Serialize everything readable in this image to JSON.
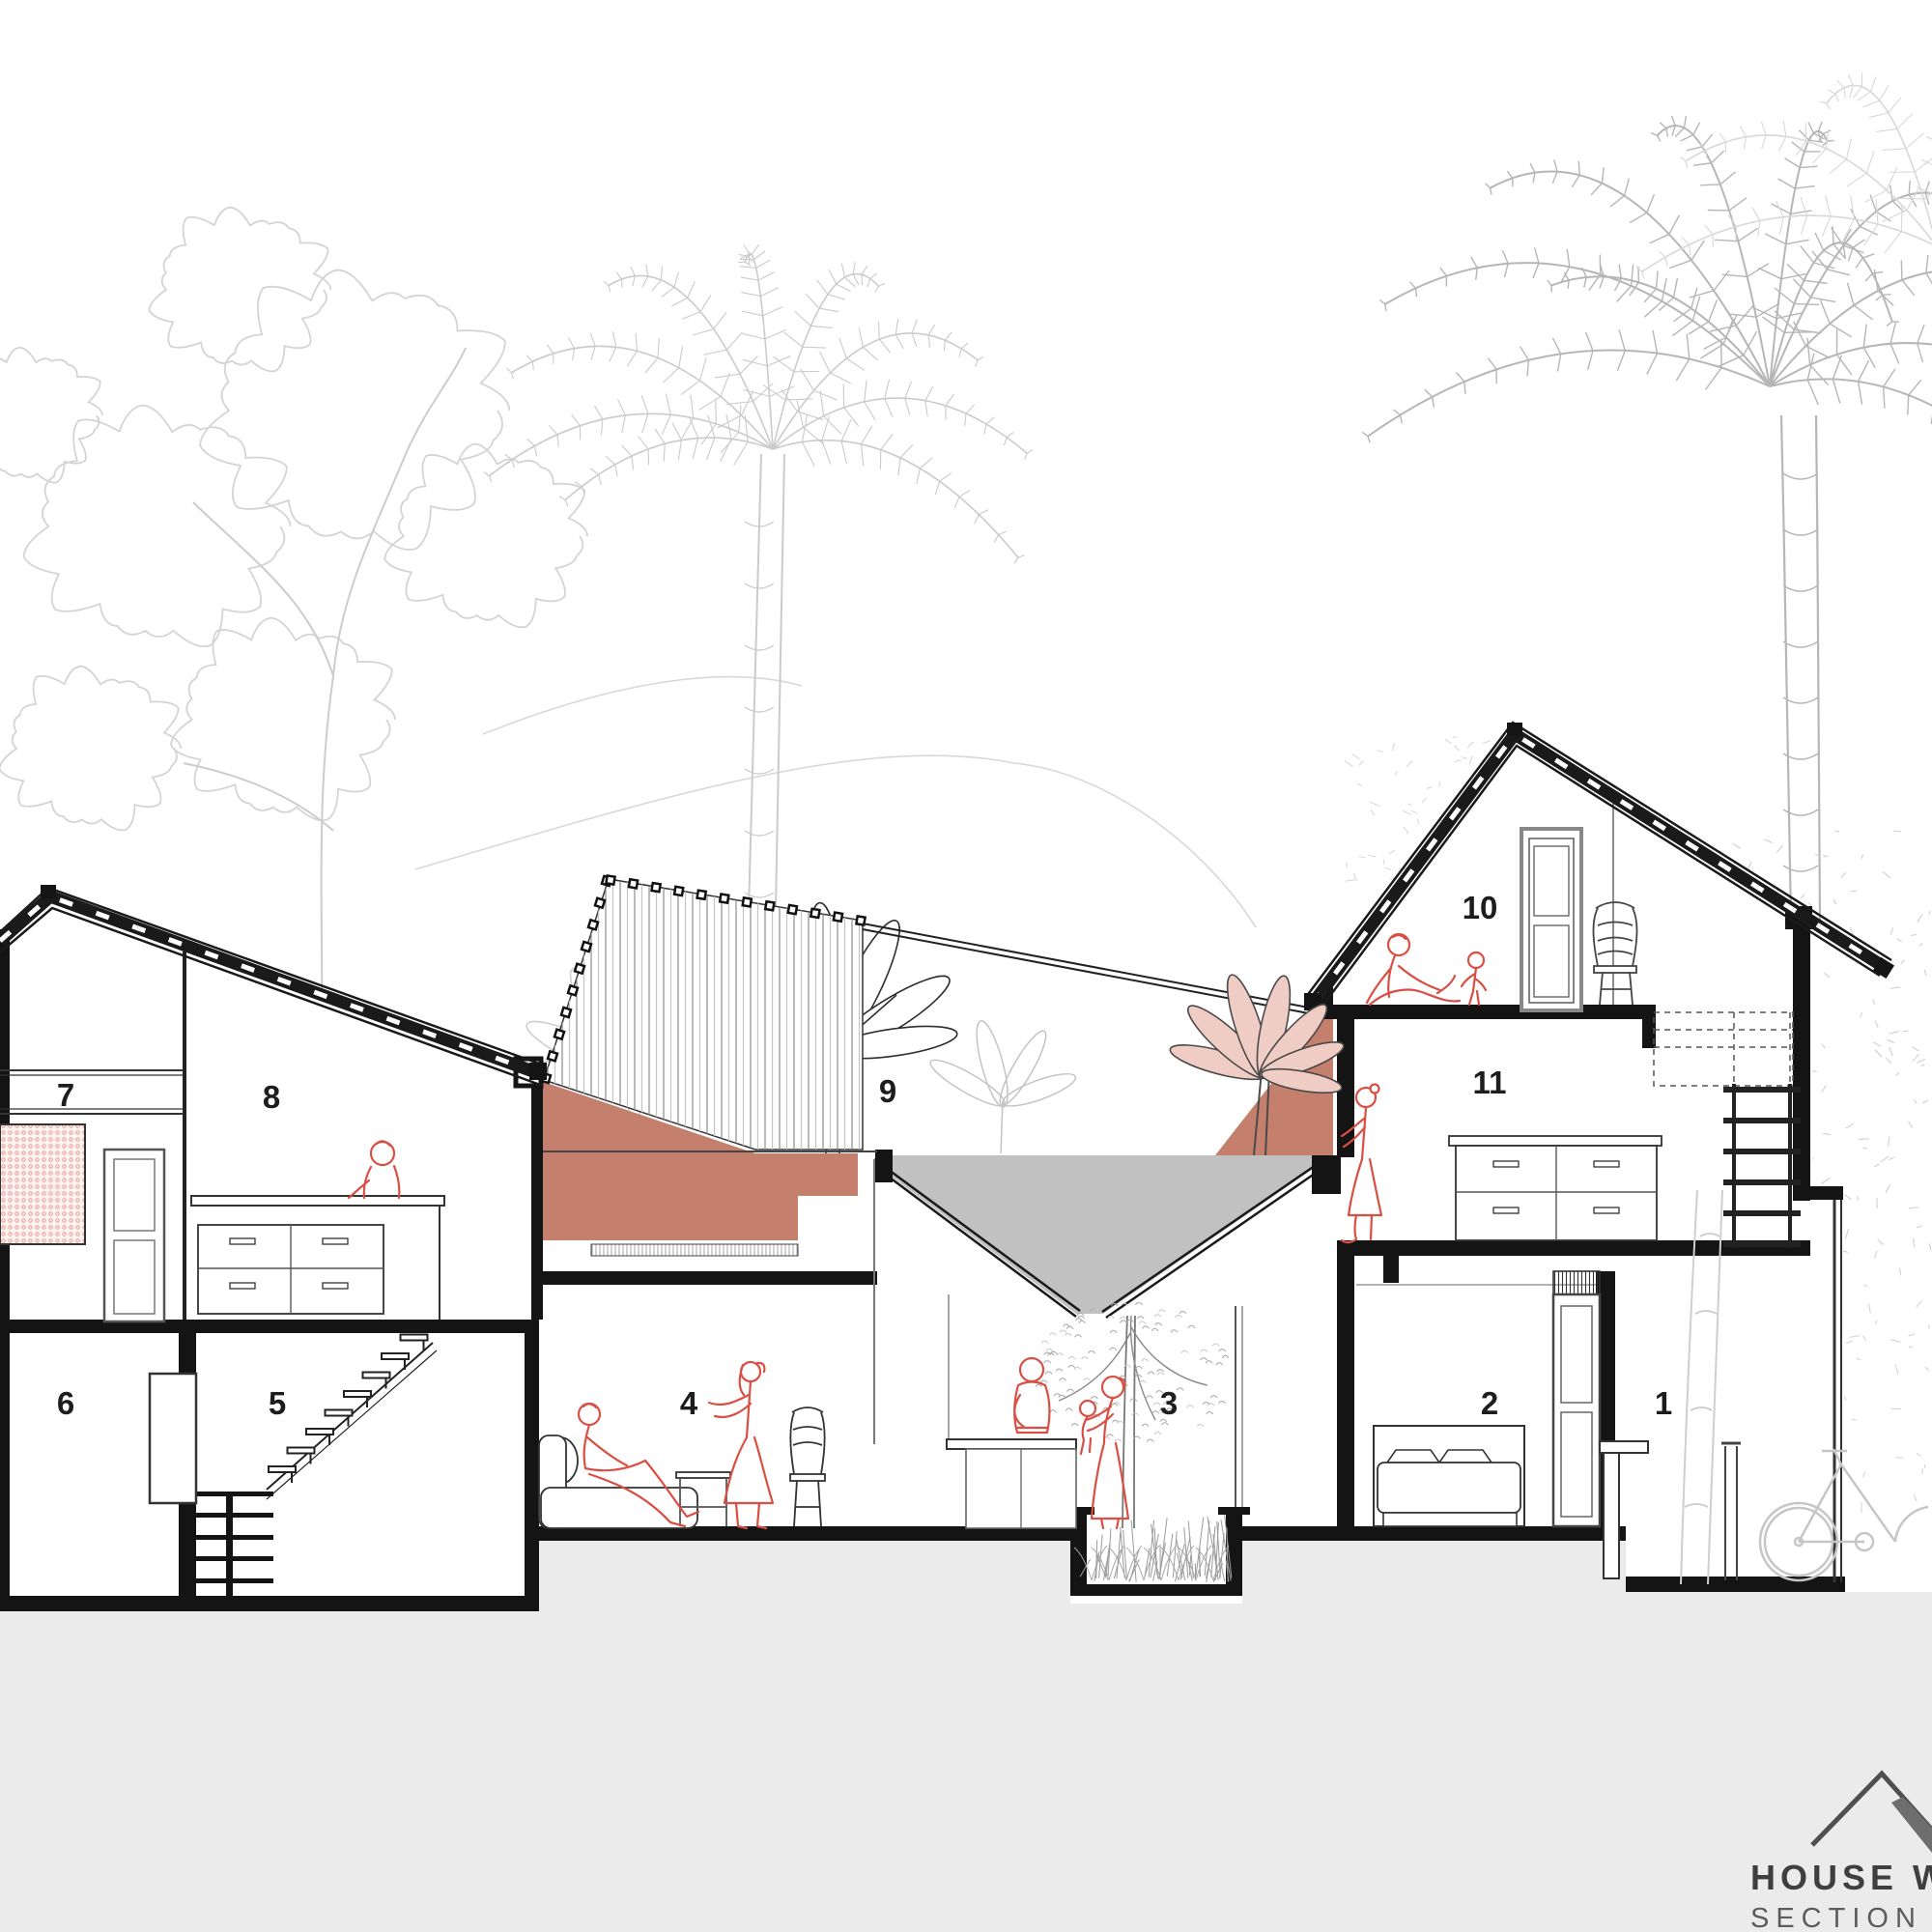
{
  "drawing": {
    "type": "architectural-section",
    "rooms": [
      "1",
      "2",
      "3",
      "4",
      "5",
      "6",
      "7",
      "8",
      "9",
      "10",
      "11"
    ],
    "logo": {
      "title": "HOUSE WIT",
      "subtitle": "SECTION - "
    },
    "colors": {
      "terracotta": "#c57f6d",
      "figure_red": "#d94f43",
      "roof_gray": "#c1c1c1",
      "ground_gray": "#ebebeb",
      "pink_leaf": "#f0cdc4",
      "pink_screen_dot": "#e09287",
      "line_black": "#1a1a1a",
      "tree_light": "#d2d2d2",
      "tree_mid": "#b5b5b5",
      "logo_text": "#3f3f3f"
    }
  }
}
